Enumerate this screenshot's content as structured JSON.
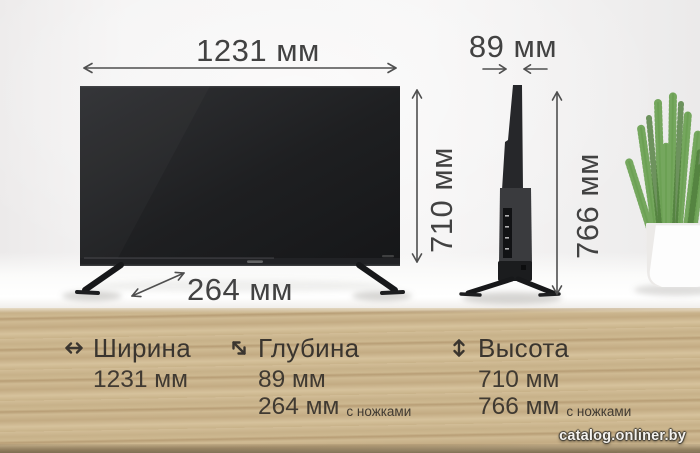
{
  "diagram": {
    "width": "1231 мм",
    "panel_depth": "89 мм",
    "panel_height": "710 мм",
    "total_height": "766 мм",
    "stand_depth": "264 мм"
  },
  "specs": {
    "width": {
      "label": "Ширина",
      "icon": "left-right-arrow-icon",
      "value": "1231 мм"
    },
    "depth": {
      "label": "Глубина",
      "icon": "diagonal-arrow-icon",
      "value1": "89 мм",
      "value2": "264 мм",
      "value2_note": "с ножками"
    },
    "height": {
      "label": "Высота",
      "icon": "up-down-arrow-icon",
      "value1": "710 мм",
      "value2": "766 мм",
      "value2_note": "с ножками"
    }
  },
  "watermark": "catalog.onliner.by",
  "colors": {
    "wood": "#c9b28a",
    "text_dark": "#3a352f",
    "arrow": "#4f4f4f",
    "plant_green": "#5d8a43",
    "tv_black": "#222325",
    "pot_white": "#fdfdfd"
  }
}
